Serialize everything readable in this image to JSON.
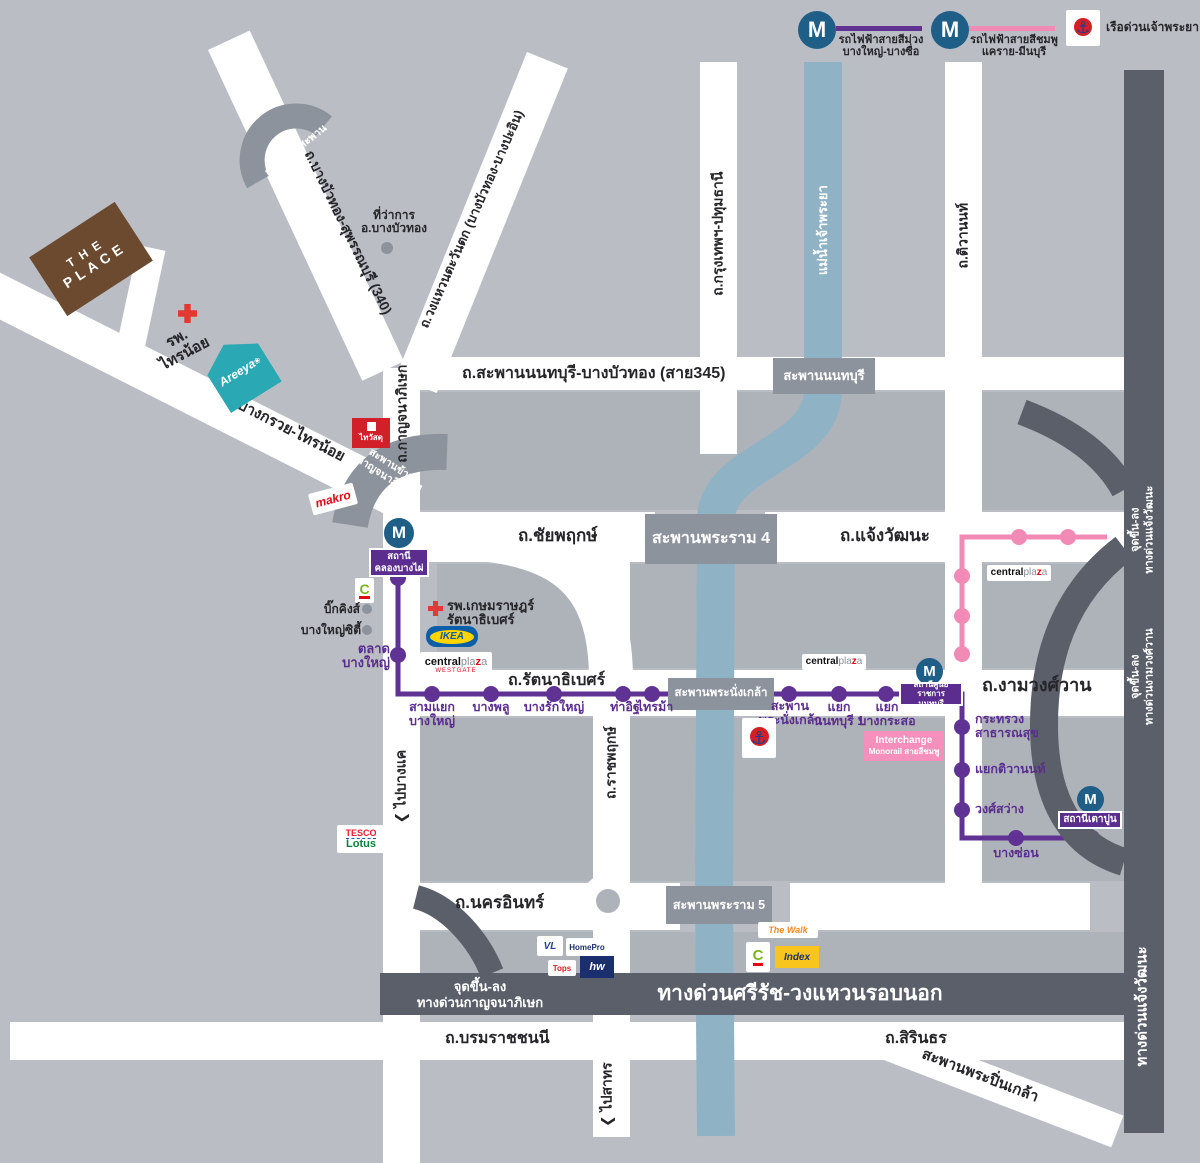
{
  "legend": {
    "m": "M",
    "purple": {
      "label": "รถไฟฟ้าสายสีม่วง",
      "route": "บางใหญ่-บางซื่อ"
    },
    "pink": {
      "label": "รถไฟฟ้าสายสีชมพู",
      "route": "แคราย-มีนบุรี"
    },
    "boat": {
      "label": "เรือด่วนเจ้าพระยา",
      "anchor": "⚓"
    }
  },
  "colors": {
    "purple_line": "#5f3293",
    "pink_line": "#f18bb5",
    "river": "#8fb3c5",
    "expressway": "#5a5f6a",
    "bridge": "#8d939c",
    "metro_blue": "#1f5e86",
    "road": "#ffffff"
  },
  "river": {
    "name": "แม่น้ำเจ้าพระยา"
  },
  "roads": {
    "sai345": "ถ.สะพานนนทบุรี-บางบัวทอง (สาย345)",
    "chaiyaphruek": "ถ.ชัยพฤกษ์",
    "chaengwattana": "ถ.แจ้งวัฒนะ",
    "rattanathibet": "ถ.รัตนาธิเบศร์",
    "ngamwongwan": "ถ.งามวงศ์วาน",
    "nakhon_in": "ถ.นครอินทร์",
    "borommaratchachonnani": "ถ.บรมราชชนนี",
    "sirindhorn": "ถ.สิรินธร",
    "pinklao_bridge": "สะพานพระปิ่นเกล้า",
    "kanchanaphisek": "ถ.กาญจนาภิเษก",
    "ratchaphruek": "ถ.ราชพฤกษ์",
    "bangkok_pathumthani": "ถ.กรุงเทพฯ-ปทุมธานี",
    "tiwanon": "ถ.ติวานนท์",
    "bang_kruai_sai_noi": "ถ.บางกรวย-ไทรน้อย",
    "bang_bua_thong_suphan": "ถ.บางบัวทอง-สุพรรณบุรี (340)",
    "west_ring": "ถ.วงแหวนตะวันตก (บางบัวทอง-บางปะอิน)",
    "to_bang_khae": "ไปบางแค",
    "to_sathorn": "ไปสาทร",
    "arrow": "❮"
  },
  "bridges": {
    "nonthaburi": "สะพานนนทบุรี",
    "rama4": "สะพานพระราม 4",
    "phra_nang_klao": "สะพานพระนั่งเกล้า",
    "rama5": "สะพานพระราม 5",
    "kanchana_cross": {
      "l1": "สะพานข้าม",
      "l2": "กาญจนาภิเษก"
    },
    "u_turn": "กลับรถใต้สะพาน"
  },
  "expressways": {
    "sirat": "ทางด่วนศรีรัช-วงแหวนรอบนอก",
    "kanchana_access": {
      "l1": "จุดขึ้น-ลง",
      "l2": "ทางด่วนกาญจนาภิเษก"
    },
    "chaengwattana_access": {
      "l1": "จุดขึ้น-ลง",
      "l2": "ทางด่วนแจ้งวัฒนะ"
    },
    "ngamwongwan_access": {
      "l1": "จุดขึ้น-ลง",
      "l2": "ทางด่วนงามวงศ์วาน"
    },
    "chaengwattana_expwy": "ทางด่วนแจ้งวัฒนะ"
  },
  "stations": {
    "khlong_bang_phai": {
      "l1": "สถานี",
      "l2": "คลองบางไผ่"
    },
    "talad_bang_yai": {
      "l1": "ตลาด",
      "l2": "บางใหญ่"
    },
    "sam_yaek_bang_yai": {
      "l1": "สามแยก",
      "l2": "บางใหญ่"
    },
    "bang_phlu": {
      "l1": "บางพลู"
    },
    "bang_rak_yai": {
      "l1": "บางรักใหญ่"
    },
    "tha_it": {
      "l1": "ท่าอิฐ"
    },
    "sai_ma": {
      "l1": "ไทรม้า"
    },
    "saphan_phra_nang_klao": {
      "l1": "สะพาน",
      "l2": "พระนั่งเกล้า"
    },
    "yaek_nonthaburi_1": {
      "l1": "แยก",
      "l2": "นนทบุรี 1"
    },
    "yaek_bang_kraso": {
      "l1": "แยก",
      "l2": "บางกระสอ"
    },
    "sun_ratchakan_nonthaburi": {
      "l1": "สถานีศูนย์ราชการ",
      "l2": "นนทบุรี"
    },
    "ministry_public_health": {
      "l1": "กระทรวง",
      "l2": "สาธารณสุข"
    },
    "yaek_tiwanon": {
      "l1": "แยกติวานนท์"
    },
    "wong_sawang": {
      "l1": "วงศ์สว่าง"
    },
    "bang_son": {
      "l1": "บางซ่อน"
    },
    "tao_pun": {
      "l1": "สถานีเตาปูน"
    },
    "interchange": {
      "l1": "Interchange",
      "l2": "Monorail สายสีชมพู"
    }
  },
  "pois": {
    "the_place": {
      "l1": "THE",
      "l2": "PLACE"
    },
    "sai_noi_hospital": {
      "l1": "รพ.",
      "l2": "ไทรน้อย"
    },
    "areeya": {
      "label": "Areeya",
      "flower": "❀"
    },
    "district_office": {
      "l1": "ที่ว่าการ",
      "l2": "อ.บางบัวทอง"
    },
    "thai_watsadu": {
      "label": "ไทวัสดุ"
    },
    "makro": {
      "label": "makro"
    },
    "big_c": {
      "label": "C"
    },
    "big_kings": {
      "label": "บิ๊กคิงส์"
    },
    "bang_yai_city": {
      "label": "บางใหญ่ซิตี้"
    },
    "kasemrad_hospital": {
      "l1": "รพ.เกษมราษฎร์",
      "l2": "รัตนาธิเบศร์"
    },
    "ikea": {
      "label": "IKEA"
    },
    "central": {
      "p1": "central",
      "p2": "pla",
      "p3": "z",
      "p4": "a",
      "westgate": "WESTGATE"
    },
    "tesco_lotus": {
      "l1": "TESCO",
      "l2": "Lotus"
    },
    "vl": {
      "label": "VL"
    },
    "homepro": {
      "label": "HomePro"
    },
    "tops": {
      "label": "Tops"
    },
    "homeworks": {
      "label": "hw"
    },
    "the_walk": {
      "label": "The Walk"
    },
    "index": {
      "label": "Index"
    }
  }
}
